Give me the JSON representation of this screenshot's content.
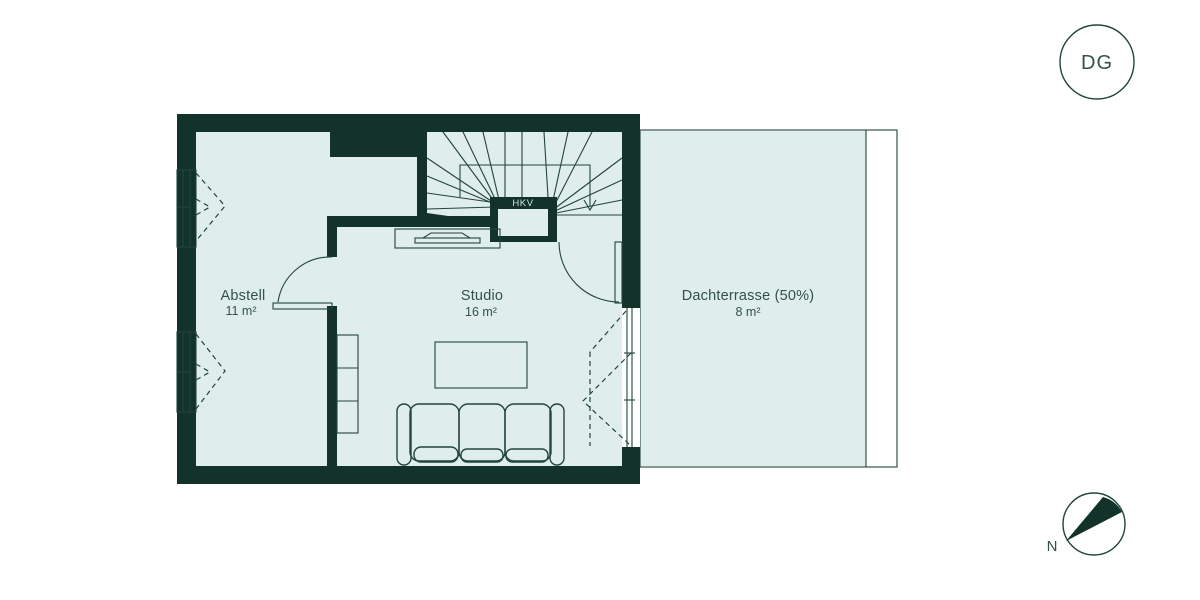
{
  "floor_plan": {
    "floor_badge": "DG",
    "compass_label": "N",
    "rooms": [
      {
        "name": "Abstell",
        "area": "11 m²"
      },
      {
        "name": "Studio",
        "area": "16 m²"
      },
      {
        "name": "Dachterrasse (50%)",
        "area": "8 m²"
      }
    ],
    "labels": {
      "stair_closet": "HKV"
    },
    "colors": {
      "wall": "#12322a",
      "room_fill": "#dfeeea",
      "line": "#22443c",
      "text": "#33514a"
    }
  }
}
